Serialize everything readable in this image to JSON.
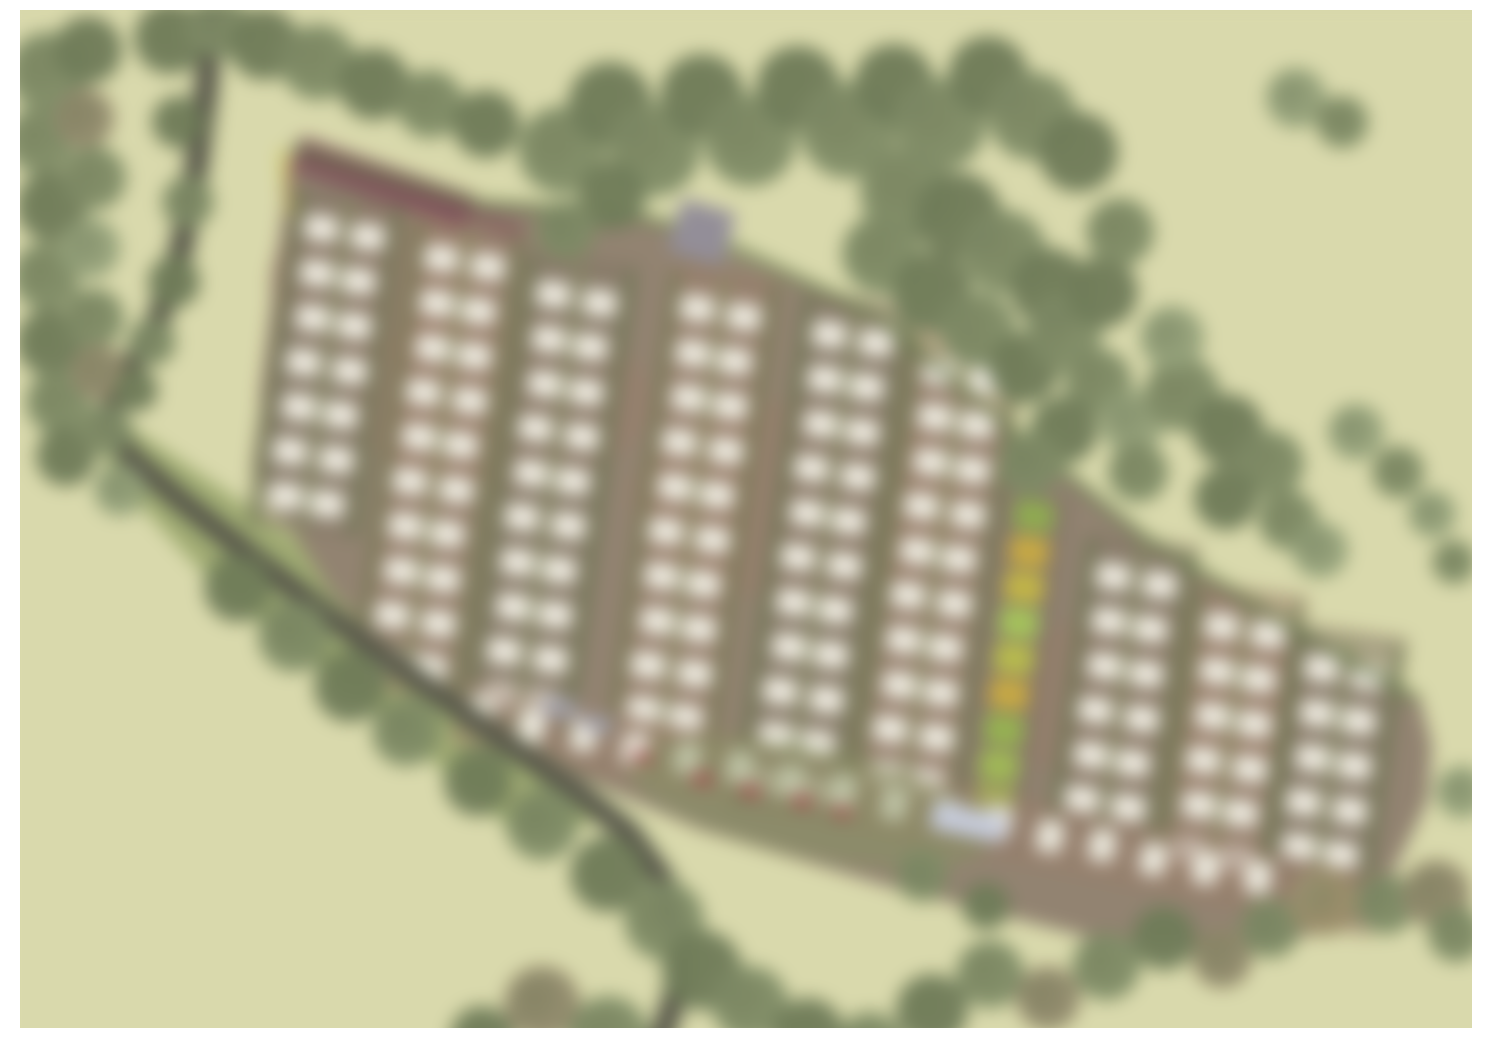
{
  "document": {
    "type": "landscape-masterplan-site-plan",
    "description": "Blurred aerial-style landscape masterplan of a caravan/lodge park: diagonal band of pitch rows on brown ground, bordered by tree belts, winding access lane on the west side, pale field background, white sheet border",
    "visible_text": []
  },
  "scene": {
    "canvas": {
      "w": 1496,
      "h": 1054
    },
    "margins": {
      "left": 20,
      "top": 10,
      "right": 24,
      "bottom": 26
    },
    "palette": {
      "paper": "#ffffff",
      "field": "#d7d7a3",
      "meadow": "#96a35f",
      "meadow_light": "#a9b26e",
      "ground": "#8d7c67",
      "ground_warm": "#96765f",
      "lane": "#7c6d5a",
      "hedge": "#5e7040",
      "hedge_light": "#7c8f55",
      "tree_d": "#66744c",
      "tree_m": "#76845a",
      "tree_l": "#8b9a6e",
      "tree_b": "#8a815f",
      "tree_b2": "#97885f",
      "road": "#49443b",
      "road_verge": "#646c4a",
      "pitch": "#eeebdf",
      "maroon": "#7d4a52",
      "yellow_line": "#cdbf45",
      "gray_building": "#8d8793",
      "gray_car": "#9b99a4",
      "blue_building": "#c3c8da",
      "red_car": "#a24043",
      "wash": "#ffffff"
    },
    "blur_px": 9,
    "band_outline": [
      [
        295,
        150
      ],
      [
        480,
        205
      ],
      [
        620,
        213
      ],
      [
        700,
        240
      ],
      [
        880,
        320
      ],
      [
        1010,
        430
      ],
      [
        1150,
        545
      ],
      [
        1300,
        635
      ],
      [
        1420,
        700
      ],
      [
        1432,
        745
      ],
      [
        1428,
        800
      ],
      [
        1370,
        920
      ],
      [
        1250,
        950
      ],
      [
        1100,
        940
      ],
      [
        900,
        890
      ],
      [
        700,
        830
      ],
      [
        545,
        762
      ],
      [
        430,
        690
      ],
      [
        330,
        590
      ],
      [
        252,
        470
      ]
    ],
    "meadow_polygon": [
      [
        118,
        418
      ],
      [
        320,
        555
      ],
      [
        430,
        672
      ],
      [
        545,
        762
      ],
      [
        612,
        820
      ],
      [
        520,
        838
      ],
      [
        380,
        718
      ],
      [
        225,
        597
      ],
      [
        105,
        468
      ]
    ],
    "ground_patches": [
      {
        "cx": 500,
        "cy": 400,
        "rx": 150,
        "ry": 90
      },
      {
        "cx": 800,
        "cy": 500,
        "rx": 170,
        "ry": 100
      },
      {
        "cx": 1150,
        "cy": 700,
        "rx": 160,
        "ry": 90
      },
      {
        "cx": 380,
        "cy": 280,
        "rx": 110,
        "ry": 80
      }
    ],
    "top_hedge_path": [
      [
        292,
        148
      ],
      [
        480,
        204
      ],
      [
        620,
        212
      ],
      [
        700,
        232
      ],
      [
        880,
        318
      ],
      [
        1010,
        428
      ],
      [
        1150,
        542
      ],
      [
        1300,
        632
      ],
      [
        1418,
        700
      ]
    ],
    "left_maroon_edge": {
      "x1": 292,
      "y1": 158,
      "x2": 262,
      "y2": 400,
      "width": 5,
      "opacity": 0.55
    },
    "maroon_bar": {
      "x1": 296,
      "y1": 153,
      "x2": 470,
      "y2": 212,
      "width": 34
    },
    "maroon_bar_tail": {
      "x1": 470,
      "y1": 212,
      "x2": 522,
      "y2": 232,
      "width": 20,
      "opacity": 0.5
    },
    "yellow_mark": {
      "x1": 283,
      "y1": 150,
      "x2": 289,
      "y2": 214,
      "width": 7
    },
    "pitch_columns": [
      {
        "x": 348,
        "y": 212,
        "rows": 7,
        "tilt": 8
      },
      {
        "x": 468,
        "y": 242,
        "rows": 10,
        "tilt": 8
      },
      {
        "x": 580,
        "y": 278,
        "rows": 10,
        "tilt": 8
      },
      {
        "x": 724,
        "y": 292,
        "rows": 10,
        "tilt": 8
      },
      {
        "x": 856,
        "y": 318,
        "rows": 11,
        "tilt": 8
      },
      {
        "x": 966,
        "y": 356,
        "rows": 10,
        "tilt": 8
      },
      {
        "x": 1140,
        "y": 560,
        "rows": 6,
        "tilt": 8
      },
      {
        "x": 1248,
        "y": 610,
        "rows": 6,
        "tilt": 8
      },
      {
        "x": 1348,
        "y": 652,
        "rows": 5,
        "tilt": 8
      }
    ],
    "cell": {
      "w": 34,
      "h": 26,
      "sub_offset": 22,
      "row_gap": 45,
      "rx": 7,
      "pad_w": 116,
      "hedge_offset": 50
    },
    "green_strip": {
      "x": 1034,
      "y": 516,
      "tilt": 8,
      "cell_w": 40,
      "cell_h": 30,
      "row_gap": 36,
      "pad_w": 72,
      "colors": [
        "#87a83f",
        "#c7a52f",
        "#c2b232",
        "#9fc24a",
        "#b5b93a",
        "#c7a52f",
        "#8fb03f",
        "#9ab644",
        "#a6bf3f"
      ]
    },
    "bottom_row": {
      "x": 480,
      "y": 714,
      "count": 17,
      "dx": 53,
      "cell_w": 25,
      "cell_h": 32,
      "tilt": 12,
      "pad_w": 86
    },
    "entrance_verge": {
      "cx": 810,
      "cy": 802,
      "rx": 185,
      "ry": 55,
      "rot": 12,
      "opacity": 0.45
    },
    "gray_building": {
      "cx": 702,
      "cy": 232,
      "w": 56,
      "h": 54,
      "rot": 16
    },
    "blue_building": {
      "cx": 968,
      "cy": 822,
      "w": 74,
      "h": 28,
      "rot": 12
    },
    "gray_cars": [
      {
        "cx": 560,
        "cy": 708,
        "w": 34,
        "h": 18,
        "rot": 10
      },
      {
        "cx": 598,
        "cy": 724,
        "w": 30,
        "h": 16,
        "rot": 10
      }
    ],
    "red_cars": [
      {
        "cx": 642,
        "cy": 757,
        "w": 20,
        "h": 11,
        "rot": 12
      },
      {
        "cx": 702,
        "cy": 779,
        "w": 20,
        "h": 11,
        "rot": 12
      },
      {
        "cx": 750,
        "cy": 791,
        "w": 20,
        "h": 11,
        "rot": 12
      },
      {
        "cx": 802,
        "cy": 801,
        "w": 20,
        "h": 11,
        "rot": 12
      },
      {
        "cx": 842,
        "cy": 812,
        "w": 18,
        "h": 10,
        "rot": 12
      }
    ],
    "road": {
      "width": 13,
      "verge": 27,
      "points": [
        [
          213,
          6
        ],
        [
          206,
          90
        ],
        [
          196,
          170
        ],
        [
          181,
          250
        ],
        [
          158,
          320
        ],
        [
          126,
          375
        ],
        [
          108,
          415
        ],
        [
          128,
          455
        ],
        [
          180,
          500
        ],
        [
          250,
          555
        ],
        [
          330,
          617
        ],
        [
          420,
          682
        ],
        [
          505,
          742
        ],
        [
          575,
          790
        ],
        [
          628,
          832
        ],
        [
          663,
          880
        ],
        [
          678,
          935
        ],
        [
          677,
          990
        ],
        [
          664,
          1030
        ],
        [
          655,
          1054
        ]
      ]
    },
    "trees": [
      [
        48,
        72,
        40,
        "m"
      ],
      [
        88,
        50,
        34,
        "d"
      ],
      [
        40,
        140,
        34,
        "m"
      ],
      [
        84,
        118,
        30,
        "b"
      ],
      [
        52,
        206,
        36,
        "d"
      ],
      [
        94,
        178,
        32,
        "m"
      ],
      [
        46,
        276,
        34,
        "m"
      ],
      [
        90,
        248,
        30,
        "l"
      ],
      [
        50,
        342,
        34,
        "d"
      ],
      [
        94,
        318,
        30,
        "m"
      ],
      [
        58,
        402,
        32,
        "m"
      ],
      [
        98,
        372,
        28,
        "b"
      ],
      [
        66,
        456,
        30,
        "d"
      ],
      [
        106,
        430,
        26,
        "m"
      ],
      [
        120,
        490,
        26,
        "l"
      ],
      [
        170,
        38,
        36,
        "d"
      ],
      [
        218,
        26,
        32,
        "m"
      ],
      [
        264,
        44,
        36,
        "d"
      ],
      [
        318,
        62,
        38,
        "m"
      ],
      [
        374,
        84,
        36,
        "d"
      ],
      [
        430,
        104,
        34,
        "m"
      ],
      [
        486,
        124,
        34,
        "d"
      ],
      [
        178,
        122,
        26,
        "d"
      ],
      [
        188,
        202,
        26,
        "m"
      ],
      [
        174,
        282,
        26,
        "d"
      ],
      [
        152,
        342,
        24,
        "m"
      ],
      [
        136,
        390,
        22,
        "d"
      ],
      [
        562,
        150,
        44,
        "m"
      ],
      [
        610,
        104,
        42,
        "d"
      ],
      [
        654,
        150,
        46,
        "m"
      ],
      [
        702,
        96,
        42,
        "d"
      ],
      [
        750,
        140,
        46,
        "m"
      ],
      [
        798,
        88,
        42,
        "d"
      ],
      [
        848,
        130,
        48,
        "m"
      ],
      [
        894,
        84,
        40,
        "d"
      ],
      [
        940,
        124,
        46,
        "m"
      ],
      [
        988,
        76,
        40,
        "d"
      ],
      [
        1032,
        116,
        44,
        "m"
      ],
      [
        1078,
        152,
        40,
        "d"
      ],
      [
        906,
        192,
        46,
        "m"
      ],
      [
        958,
        216,
        44,
        "d"
      ],
      [
        1004,
        252,
        42,
        "m"
      ],
      [
        1050,
        288,
        40,
        "d"
      ],
      [
        882,
        254,
        40,
        "m"
      ],
      [
        932,
        292,
        40,
        "d"
      ],
      [
        978,
        330,
        38,
        "m"
      ],
      [
        1024,
        368,
        36,
        "d"
      ],
      [
        1064,
        332,
        38,
        "m"
      ],
      [
        1102,
        292,
        36,
        "d"
      ],
      [
        1120,
        232,
        34,
        "m"
      ],
      [
        1098,
        382,
        34,
        "m"
      ],
      [
        1064,
        430,
        34,
        "d"
      ],
      [
        1030,
        464,
        32,
        "m"
      ],
      [
        1132,
        422,
        32,
        "l"
      ],
      [
        1138,
        472,
        30,
        "m"
      ],
      [
        612,
        196,
        34,
        "d"
      ],
      [
        566,
        230,
        30,
        "m"
      ],
      [
        1182,
        394,
        38,
        "m"
      ],
      [
        1228,
        430,
        36,
        "d"
      ],
      [
        1270,
        464,
        34,
        "m"
      ],
      [
        1226,
        498,
        32,
        "d"
      ],
      [
        1288,
        520,
        30,
        "m"
      ],
      [
        1320,
        550,
        28,
        "l"
      ],
      [
        1172,
        338,
        32,
        "l"
      ],
      [
        1356,
        432,
        28,
        "l"
      ],
      [
        1398,
        472,
        26,
        "m"
      ],
      [
        1432,
        514,
        24,
        "l"
      ],
      [
        1454,
        562,
        22,
        "m"
      ],
      [
        1296,
        98,
        30,
        "l"
      ],
      [
        1342,
        122,
        26,
        "m"
      ],
      [
        238,
        588,
        34,
        "d"
      ],
      [
        294,
        636,
        36,
        "m"
      ],
      [
        350,
        686,
        36,
        "d"
      ],
      [
        406,
        732,
        34,
        "m"
      ],
      [
        478,
        782,
        34,
        "d"
      ],
      [
        542,
        824,
        36,
        "m"
      ],
      [
        608,
        874,
        38,
        "d"
      ],
      [
        664,
        920,
        40,
        "m"
      ],
      [
        702,
        970,
        40,
        "d"
      ],
      [
        750,
        1004,
        38,
        "m"
      ],
      [
        808,
        1034,
        36,
        "d"
      ],
      [
        870,
        1046,
        34,
        "m"
      ],
      [
        542,
        1004,
        38,
        "b"
      ],
      [
        608,
        1036,
        40,
        "m"
      ],
      [
        482,
        1038,
        32,
        "d"
      ],
      [
        932,
        1010,
        36,
        "d"
      ],
      [
        990,
        974,
        34,
        "m"
      ],
      [
        1048,
        998,
        32,
        "b"
      ],
      [
        1106,
        966,
        34,
        "m"
      ],
      [
        1164,
        938,
        32,
        "d"
      ],
      [
        1222,
        958,
        30,
        "b"
      ],
      [
        1270,
        928,
        30,
        "m"
      ],
      [
        1324,
        902,
        34,
        "b2"
      ],
      [
        1386,
        904,
        30,
        "m"
      ],
      [
        1436,
        894,
        34,
        "b"
      ],
      [
        1456,
        934,
        28,
        "m"
      ],
      [
        1462,
        792,
        26,
        "l"
      ],
      [
        922,
        876,
        26,
        "m"
      ],
      [
        986,
        906,
        24,
        "d"
      ]
    ],
    "wash_opacity": 0.06
  }
}
